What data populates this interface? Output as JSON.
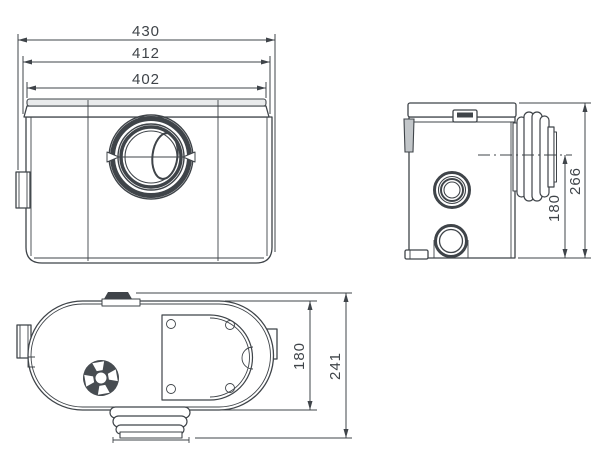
{
  "drawing": {
    "background": "#ffffff",
    "line_color": "#3f4449",
    "views": {
      "front": {
        "dim_overall_width": "430",
        "dim_lid_width": "412",
        "dim_top_width": "402"
      },
      "side": {
        "dim_outlet_center_height": "180",
        "dim_overall_height": "266"
      },
      "top": {
        "dim_body_depth": "180",
        "dim_overall_depth": "241"
      }
    }
  }
}
